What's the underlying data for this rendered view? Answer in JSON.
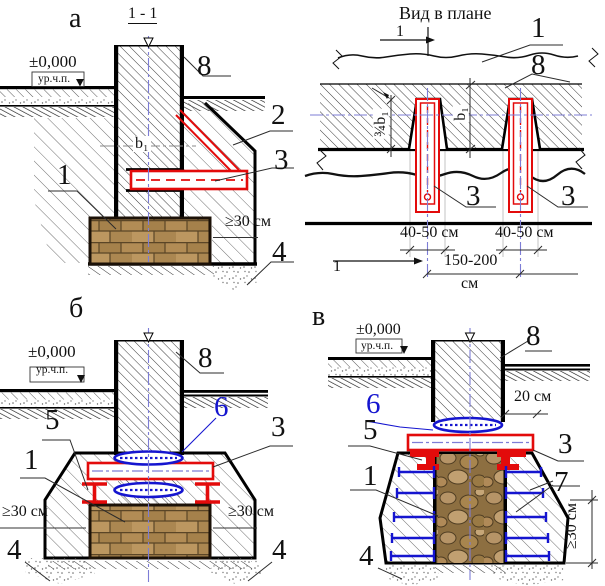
{
  "drawing": {
    "section_a": {
      "letter": "а",
      "cut_title": "1 - 1",
      "elevation": "±0,000",
      "level": "ур.ч.п.",
      "width_dim": "b₁",
      "depth_dim": "≥30 см",
      "callout_foundation": "1",
      "callout_strut": "2",
      "callout_beam": "3",
      "callout_sand": "4",
      "callout_wall": "8"
    },
    "plan": {
      "title": "Вид в плане",
      "cut_mark_top": "1",
      "cut_mark_bottom": "1",
      "callout_foundation": "1",
      "callout_wall": "8",
      "callout_beam_left": "3",
      "callout_beam_right": "3",
      "niche_width_left": "40-50 см",
      "niche_width_right": "40-50 см",
      "spacing_value": "150-200",
      "spacing_unit": "см",
      "wall_width_dim": "b₁",
      "niche_depth_dim": "¾b₁"
    },
    "section_b": {
      "letter": "б",
      "elevation": "±0,000",
      "level": "ур.ч.п.",
      "callout_wall": "8",
      "callout_pad": "6",
      "callout_beam": "3",
      "callout_support": "5",
      "callout_foundation": "1",
      "callout_sand_left": "4",
      "callout_sand_right": "4",
      "depth_dim_left": "≥30 см",
      "depth_dim_right": "≥30 см"
    },
    "section_v": {
      "letter": "в",
      "elevation": "±0,000",
      "level": "ур.ч.п.",
      "callout_wall": "8",
      "callout_pad": "6",
      "callout_plate": "3",
      "callout_angle": "5",
      "callout_foundation": "1",
      "callout_jacket": "7",
      "callout_sand": "4",
      "offset_dim": "20 см",
      "height_dim": "≥30 см"
    },
    "colors": {
      "reinforcement_red": "#e30b0b",
      "pad_blue": "#1515cf",
      "centerline_blue": "#7d7dd6"
    }
  }
}
